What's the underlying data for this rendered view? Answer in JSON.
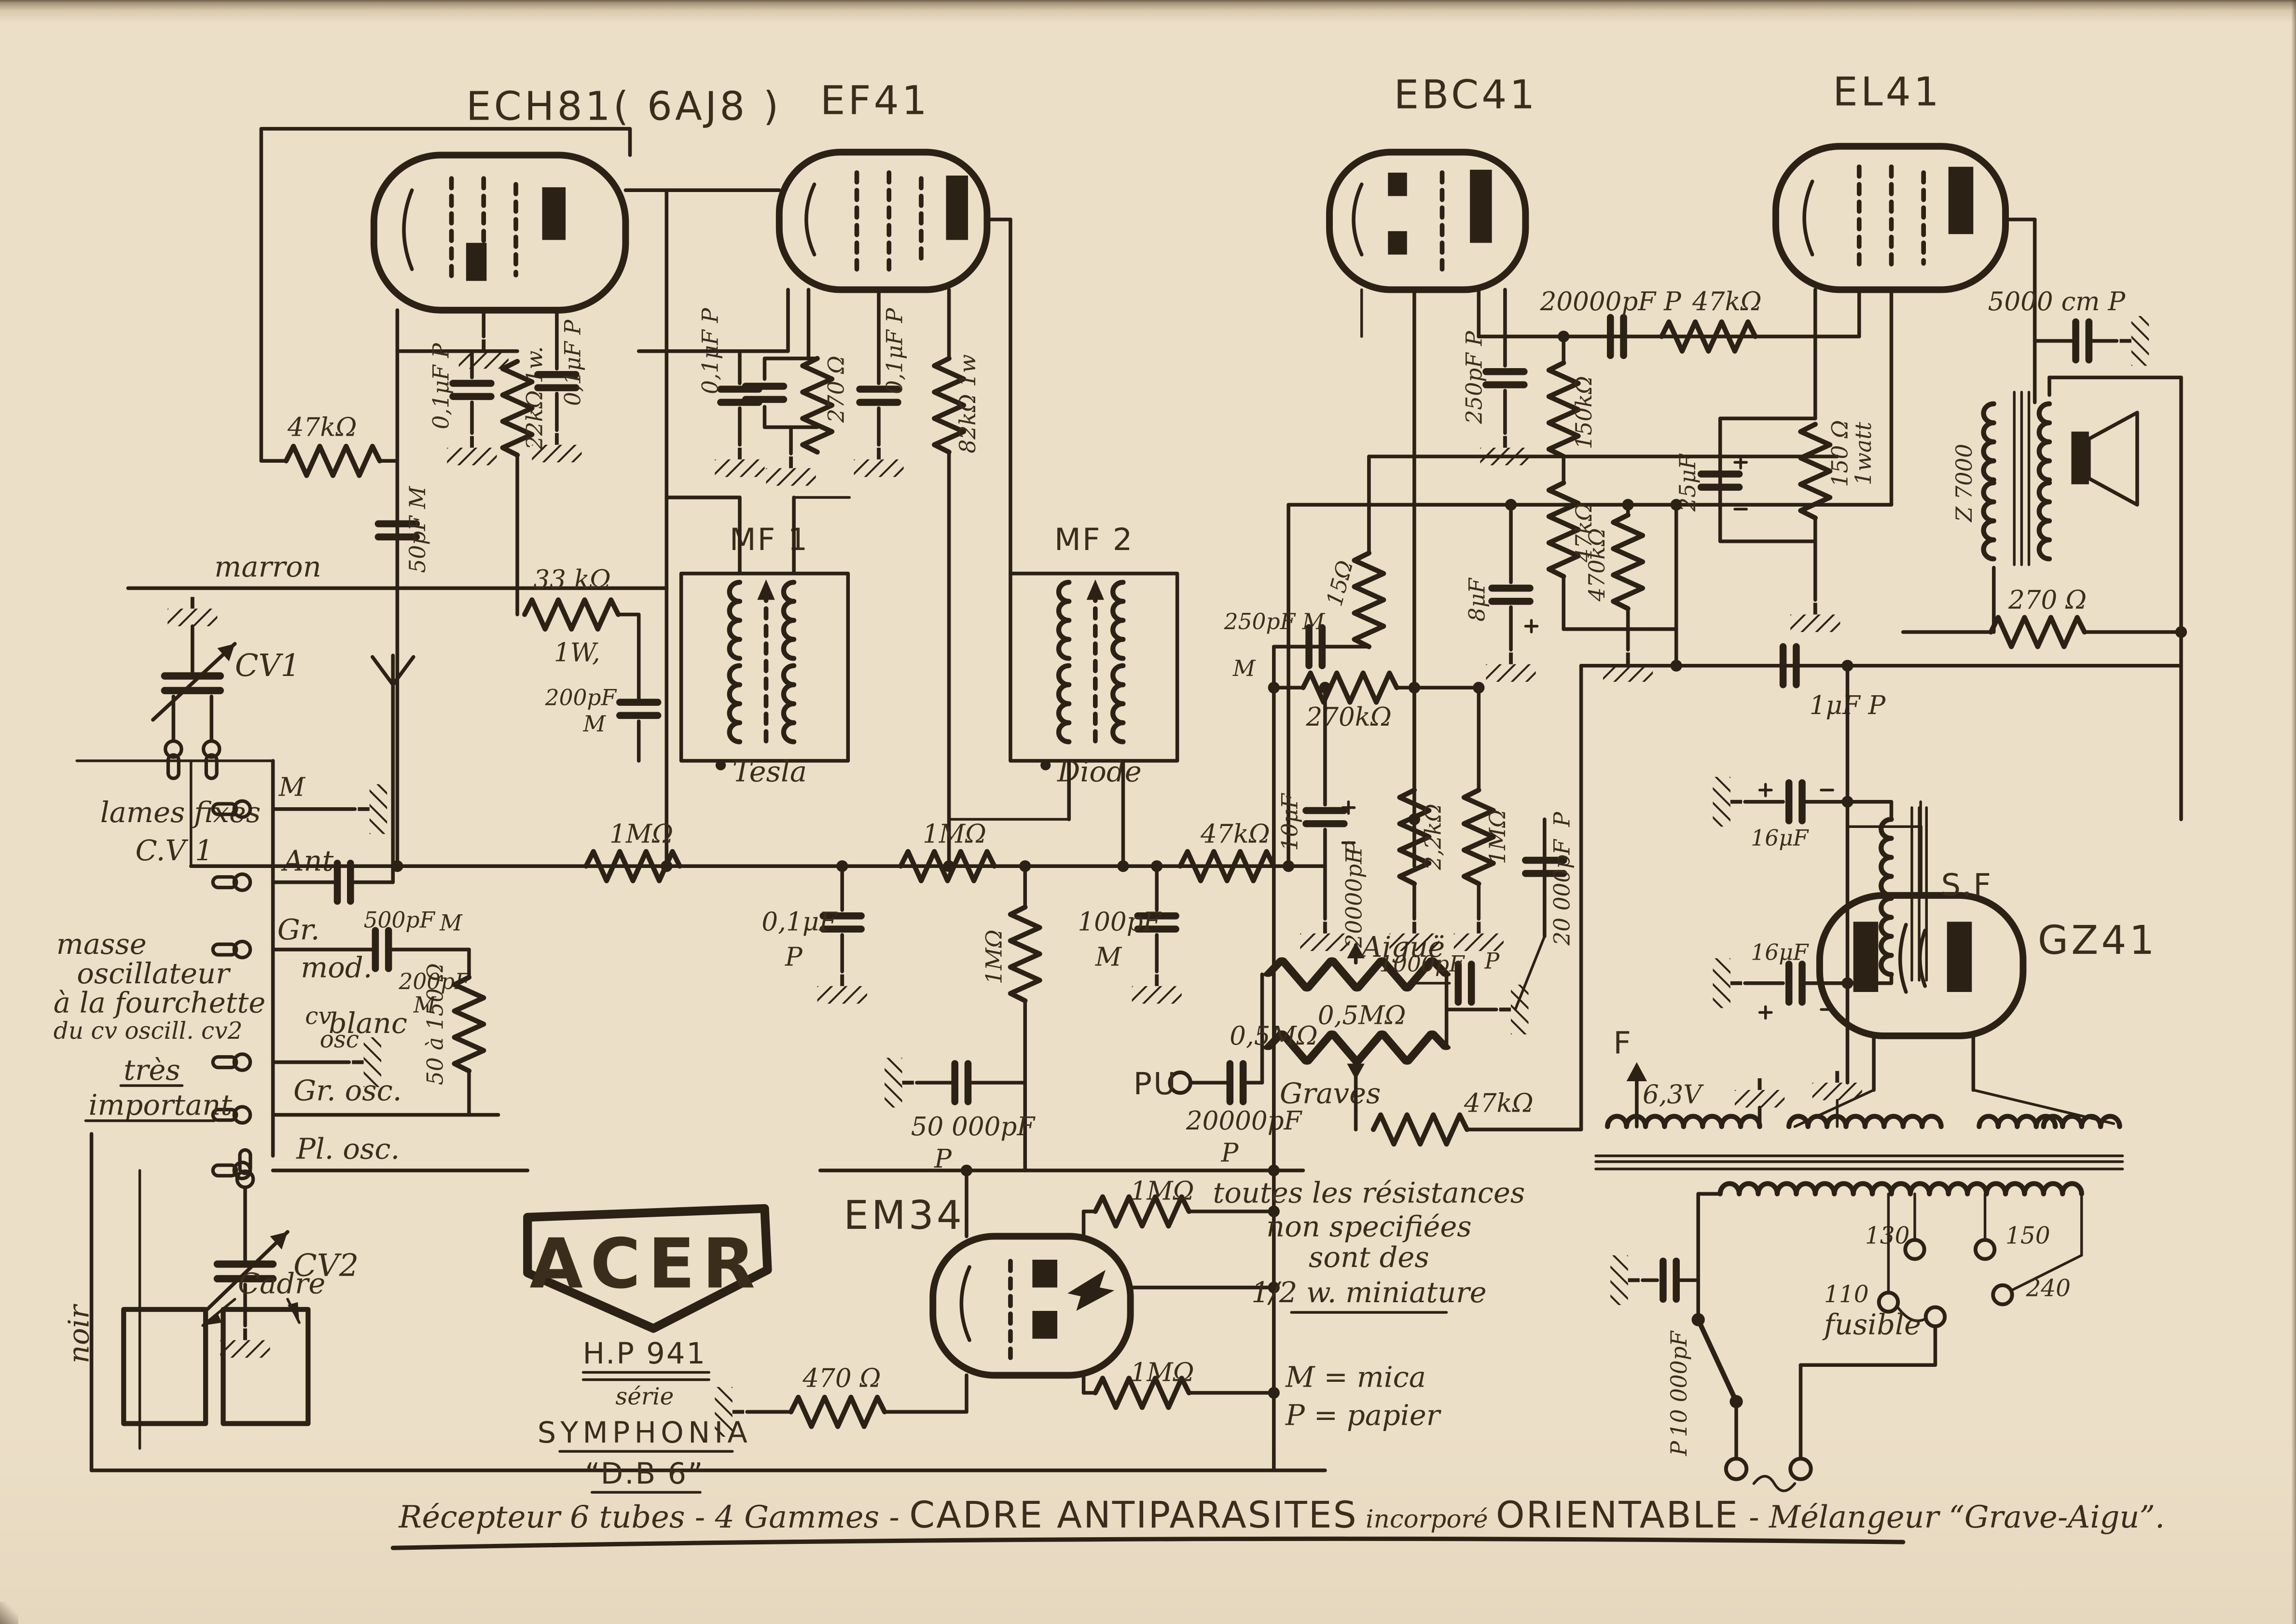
{
  "doc_type": "vintage radio schematic (scanned)",
  "brand": {
    "logo": "ACER",
    "model": "H.P 941",
    "serie": "série",
    "series_name": "SYMPHONIA",
    "variant": "“D.B 6”"
  },
  "caption": {
    "part1": "Récepteur 6 tubes - 4 Gammes - ",
    "part2": "CADRE ANTIPARASITES",
    "part3": " incorporé ",
    "part4": "ORIENTABLE",
    "part5": " - Mélangeur ",
    "part6": "“Grave-Aigu”."
  },
  "colors": {
    "paper": "#ecdfc7",
    "ink": "#2b2115"
  },
  "t": {
    "ech81": "ECH81( 6AJ8 )",
    "ef41": "EF41",
    "ebc41": "EBC41",
    "el41": "EL41",
    "gz41": "GZ41",
    "em34": "EM34",
    "mf1": "MF 1",
    "mf2": "MF 2",
    "tesla": "Tesla",
    "diode": "Diode",
    "sf": "S.F",
    "z7000": "Z 7000",
    "marron": "marron",
    "blanc": "blanc",
    "noir": "noir",
    "cv1": "CV1",
    "cv2": "CV2",
    "cadre": "Cadre",
    "lames": "lames fixes",
    "cv1ref": "C.V 1",
    "m": "M",
    "ant": "Ant",
    "gr": "Gr.",
    "mod": "mod.",
    "c500": "500pF",
    "c500m": "M",
    "c200": "200pF",
    "c200m": "M",
    "masse1": "masse",
    "masse2": "oscillateur",
    "masse3": "à la fourchette",
    "masse4": "du cv oscill. cv2",
    "cvosc1": "cv",
    "cvosc2": "osc",
    "tres": "très",
    "important": "important",
    "grosc": "Gr. osc.",
    "plosc": "Pl. osc.",
    "rpad": "50 à 150 Ω",
    "r47k_avc": "47kΩ",
    "c50pf": "50pF M",
    "c01a": "0,1μF P",
    "r22k": "22kΩ.1w.",
    "r33k": "33 kΩ",
    "r33kw": "1W,",
    "cg200": "200pF",
    "cg200m": "M",
    "r1m_a": "1MΩ",
    "c01b": "0,1μF P",
    "r270c": "270 Ω",
    "c01c": "0,1μF P",
    "r82k": "82kΩ 1w",
    "r1m_b": "1MΩ",
    "c01d1": "0,1μF",
    "c01d2": "P",
    "r1m_c": "1MΩ",
    "c50000": "50 000pF",
    "c50000p": "P",
    "c100": "100pF",
    "c100m": "M",
    "r47k_det": "47kΩ",
    "pu": "PU",
    "c20000": "20000pF",
    "c20000p": "P",
    "c250m": "250pF M",
    "c250m2": "M",
    "r15": "15Ω",
    "r270k": "270kΩ",
    "c10uf": "10μF",
    "r2k2": "2,2kΩ",
    "r1m_d": "1MΩ",
    "c20kv1": "20000pF",
    "c20kv1p": "P",
    "c20kv2": "20 000pF",
    "c20kv2p": "P",
    "c1000": "1000pF",
    "c1000p": "P",
    "aigue": "Aiguë",
    "pot1": "0,5MΩ",
    "pot2": "0,5MΩ",
    "graves": "Graves",
    "r47k_tone": "47kΩ",
    "c250p": "250pF P",
    "c8uf": "8μF",
    "r150k": "150kΩ",
    "r47k_dec": "47kΩ",
    "r470k": "470kΩ",
    "c25uf": "25μF",
    "r150": "150 Ω",
    "r150w": "1watt",
    "c20k_coup": "20000pF P",
    "r47k_el": "47kΩ",
    "c5000": "5000 cm P",
    "r270_nfb": "270 Ω",
    "c1uf": "1μF P",
    "c16a": "16μF",
    "c16b": "16μF",
    "f": "F",
    "v63": "6,3V",
    "t110": "110",
    "t130": "130",
    "t150": "150",
    "t240": "240",
    "fusible": "fusible",
    "c10000": "10 000pF",
    "c10000p": "P",
    "note1": "toutes les résistances",
    "note2": "non specifiées",
    "note3": "sont des",
    "note4": "1/2 w. miniature",
    "mica": "M = mica",
    "papier": "P = papier",
    "r1m_e": "1MΩ",
    "r1m_f": "1MΩ",
    "r470": "470 Ω"
  }
}
